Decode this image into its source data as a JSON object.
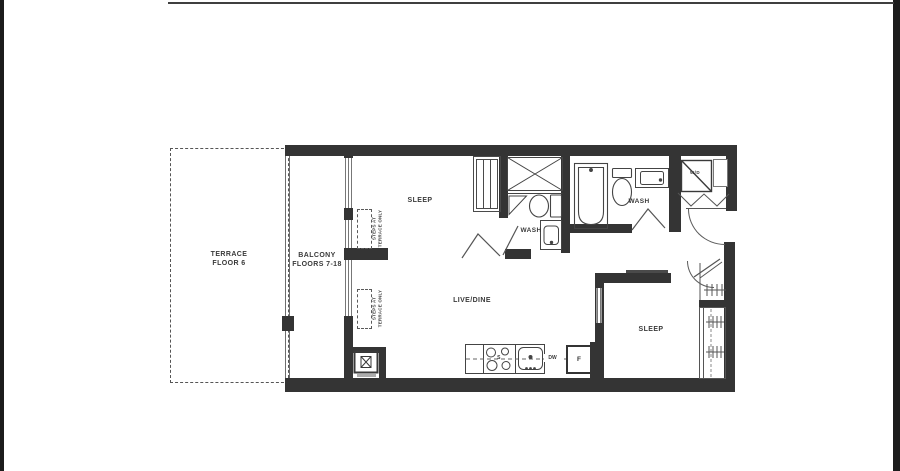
{
  "floorplan": {
    "terrace": {
      "line1": "TERRACE",
      "line2": "FLOOR 6"
    },
    "balcony": {
      "line1": "BALCONY",
      "line2": "FLOORS 7-18"
    },
    "steps_note": {
      "line1": "STEPS AT",
      "line2": "TERRACE ONLY"
    },
    "bedroom1_label": "SLEEP",
    "bedroom2_label": "SLEEP",
    "bath1_label": "WASH",
    "bath2_label": "WASH",
    "living_label": "LIVE/DINE",
    "laundry_label": "W/D",
    "kitchen": {
      "stove": "S",
      "dishwasher": "DW",
      "fridge": "F"
    },
    "colors": {
      "wall": "#343434",
      "thin_line": "#5a5a5a",
      "text": "#3a3a3a",
      "page": "#ffffff",
      "scan_border": "#1c1c1c"
    }
  }
}
